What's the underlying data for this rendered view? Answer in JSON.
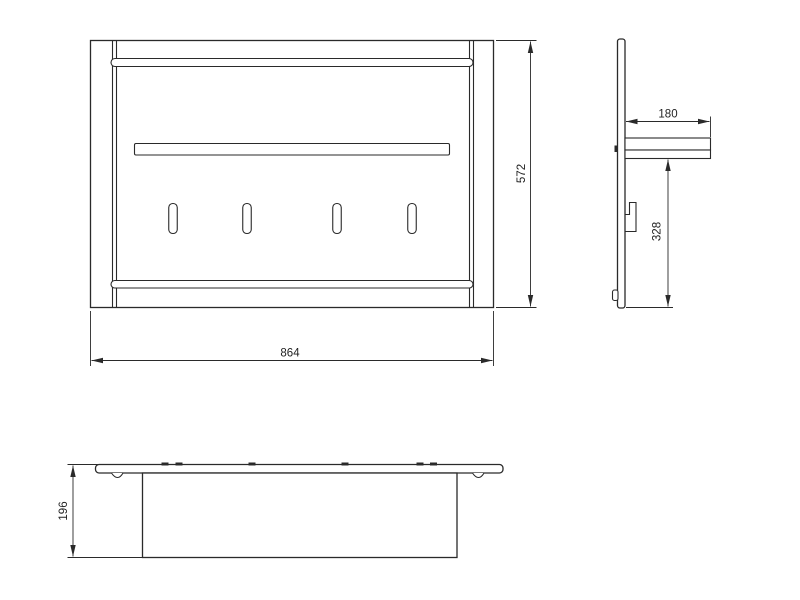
{
  "drawing": {
    "kind": "technical-drawing",
    "background_color": "#ffffff",
    "line_color": "#2a2a2a",
    "views": {
      "front": {
        "name": "front-view",
        "width_label": "864",
        "height_label": "572"
      },
      "side": {
        "name": "side-view",
        "shelf_depth_label": "180",
        "lower_height_label": "328"
      },
      "top": {
        "name": "top-view",
        "depth_label": "196"
      }
    }
  }
}
